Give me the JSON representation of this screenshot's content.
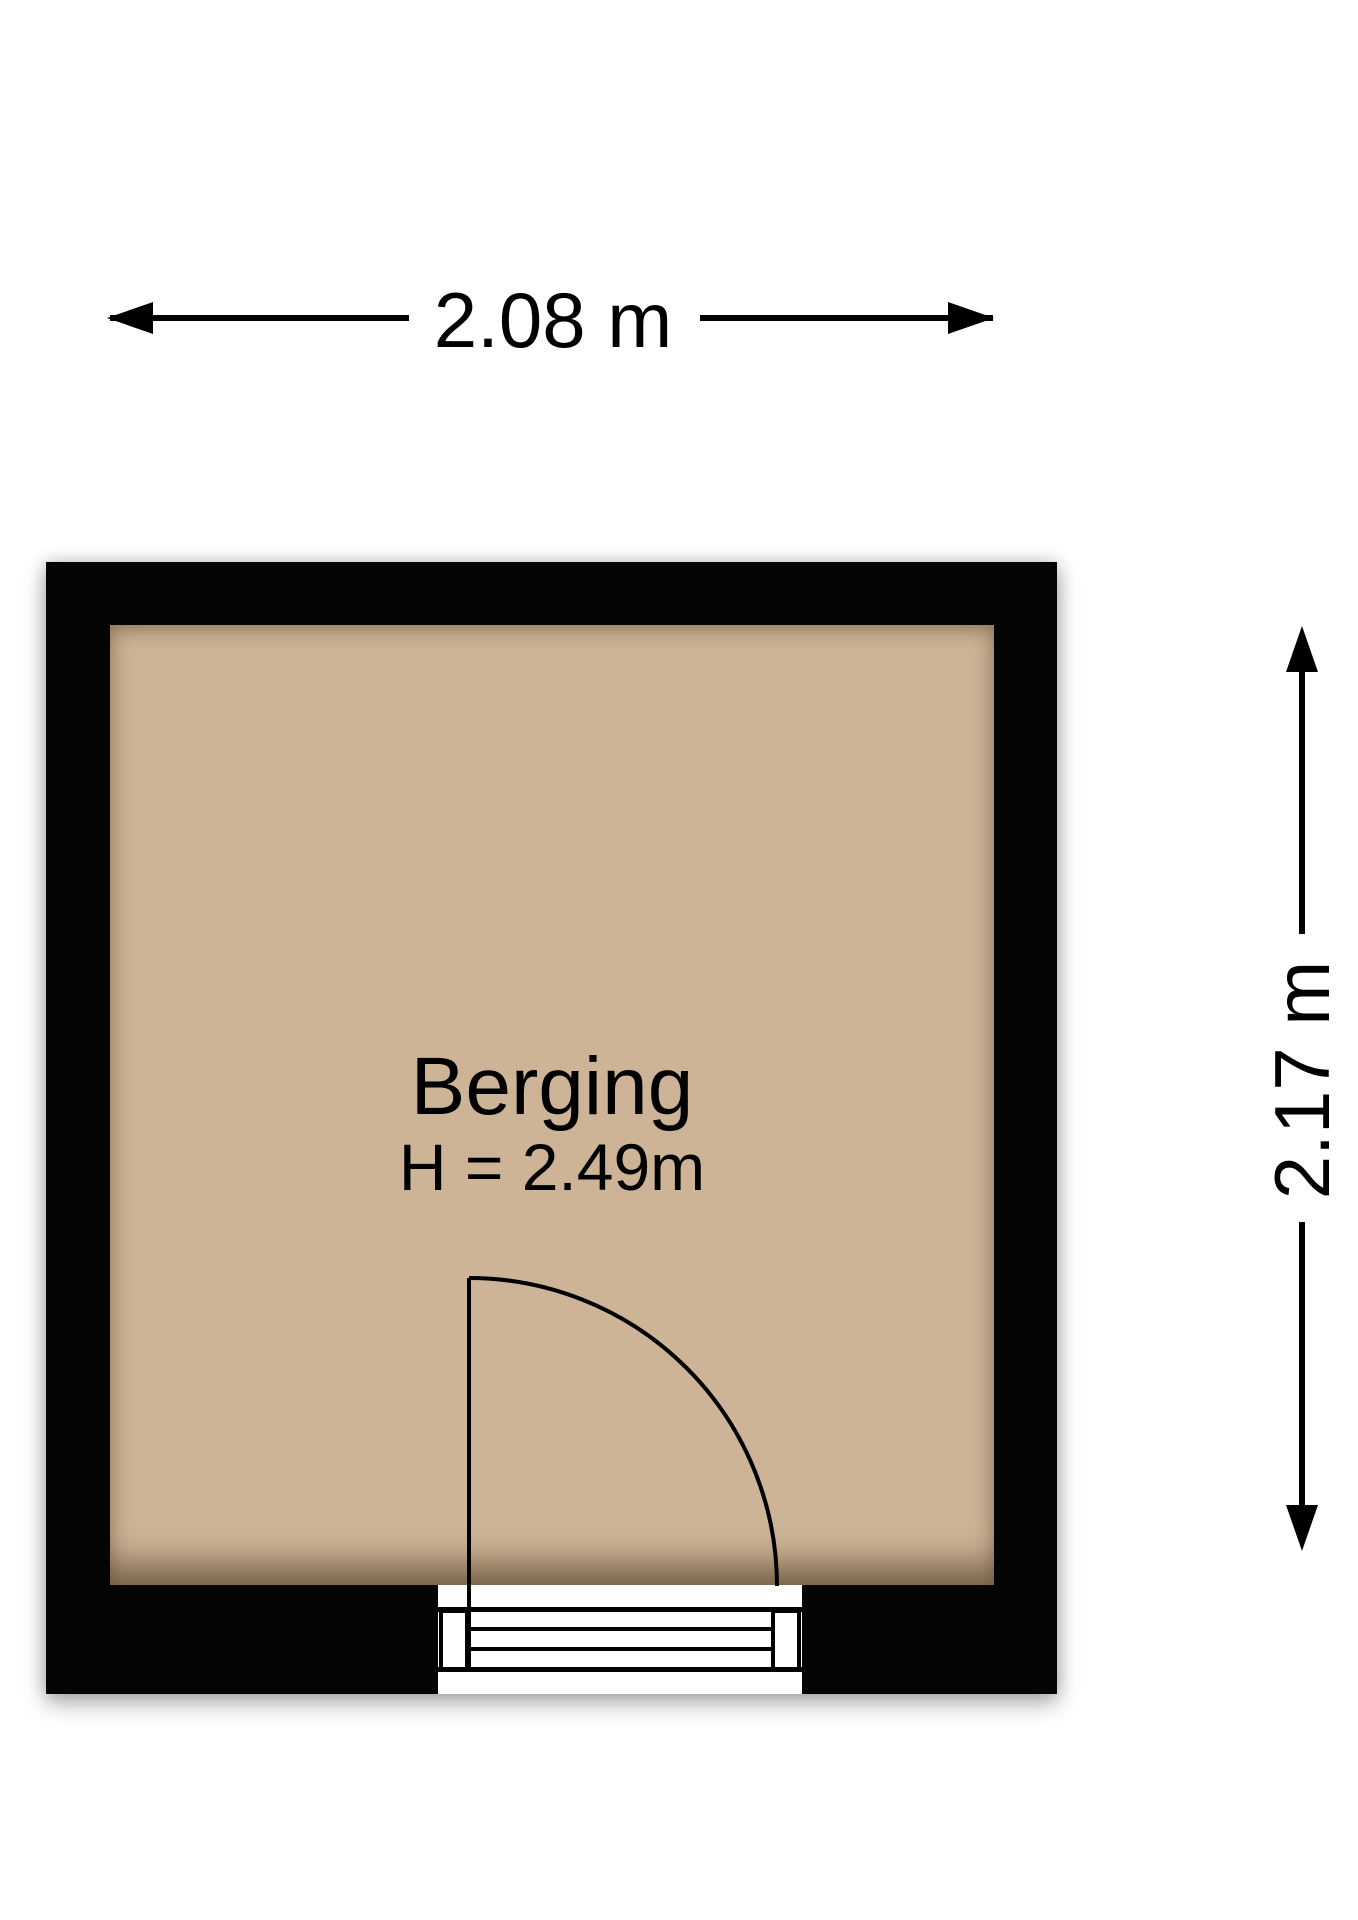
{
  "floorplan": {
    "room": {
      "name": "Berging",
      "height_label": "H = 2.49m"
    },
    "dimensions": {
      "width_label": "2.08 m",
      "depth_label": "2.17 m"
    },
    "door": {
      "type": "single-swing-door",
      "swing": "quarter-circle"
    },
    "icons": {
      "arrowhead_left": "dimension-arrow-left",
      "arrowhead_right": "dimension-arrow-right",
      "arrowhead_up": "dimension-arrow-up",
      "arrowhead_down": "dimension-arrow-down"
    },
    "colors": {
      "ink": "#000000",
      "wall": "#050505",
      "floor": "#cdb496",
      "bg": "#ffffff"
    }
  }
}
